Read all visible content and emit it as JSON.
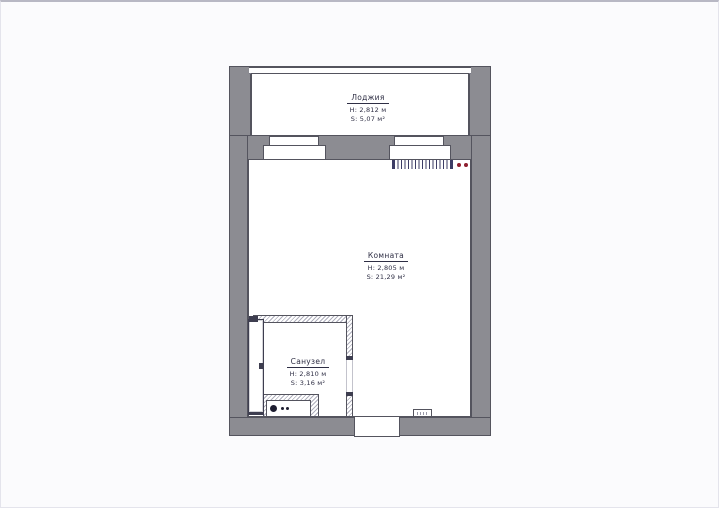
{
  "plan": {
    "rooms": [
      {
        "name": "Лоджия",
        "height": "H: 2,812 м",
        "area": "S: 5,07 м²"
      },
      {
        "name": "Комната",
        "height": "H: 2,805 м",
        "area": "S: 21,29 м²"
      },
      {
        "name": "Санузел",
        "height": "H: 2,810 м",
        "area": "S: 3,16 м²"
      }
    ],
    "colors": {
      "wall": "#8c8c92",
      "line": "#54545e",
      "text": "#2e2e44",
      "radiator": "#3d3d66",
      "socket": "#8e1f2f"
    }
  }
}
